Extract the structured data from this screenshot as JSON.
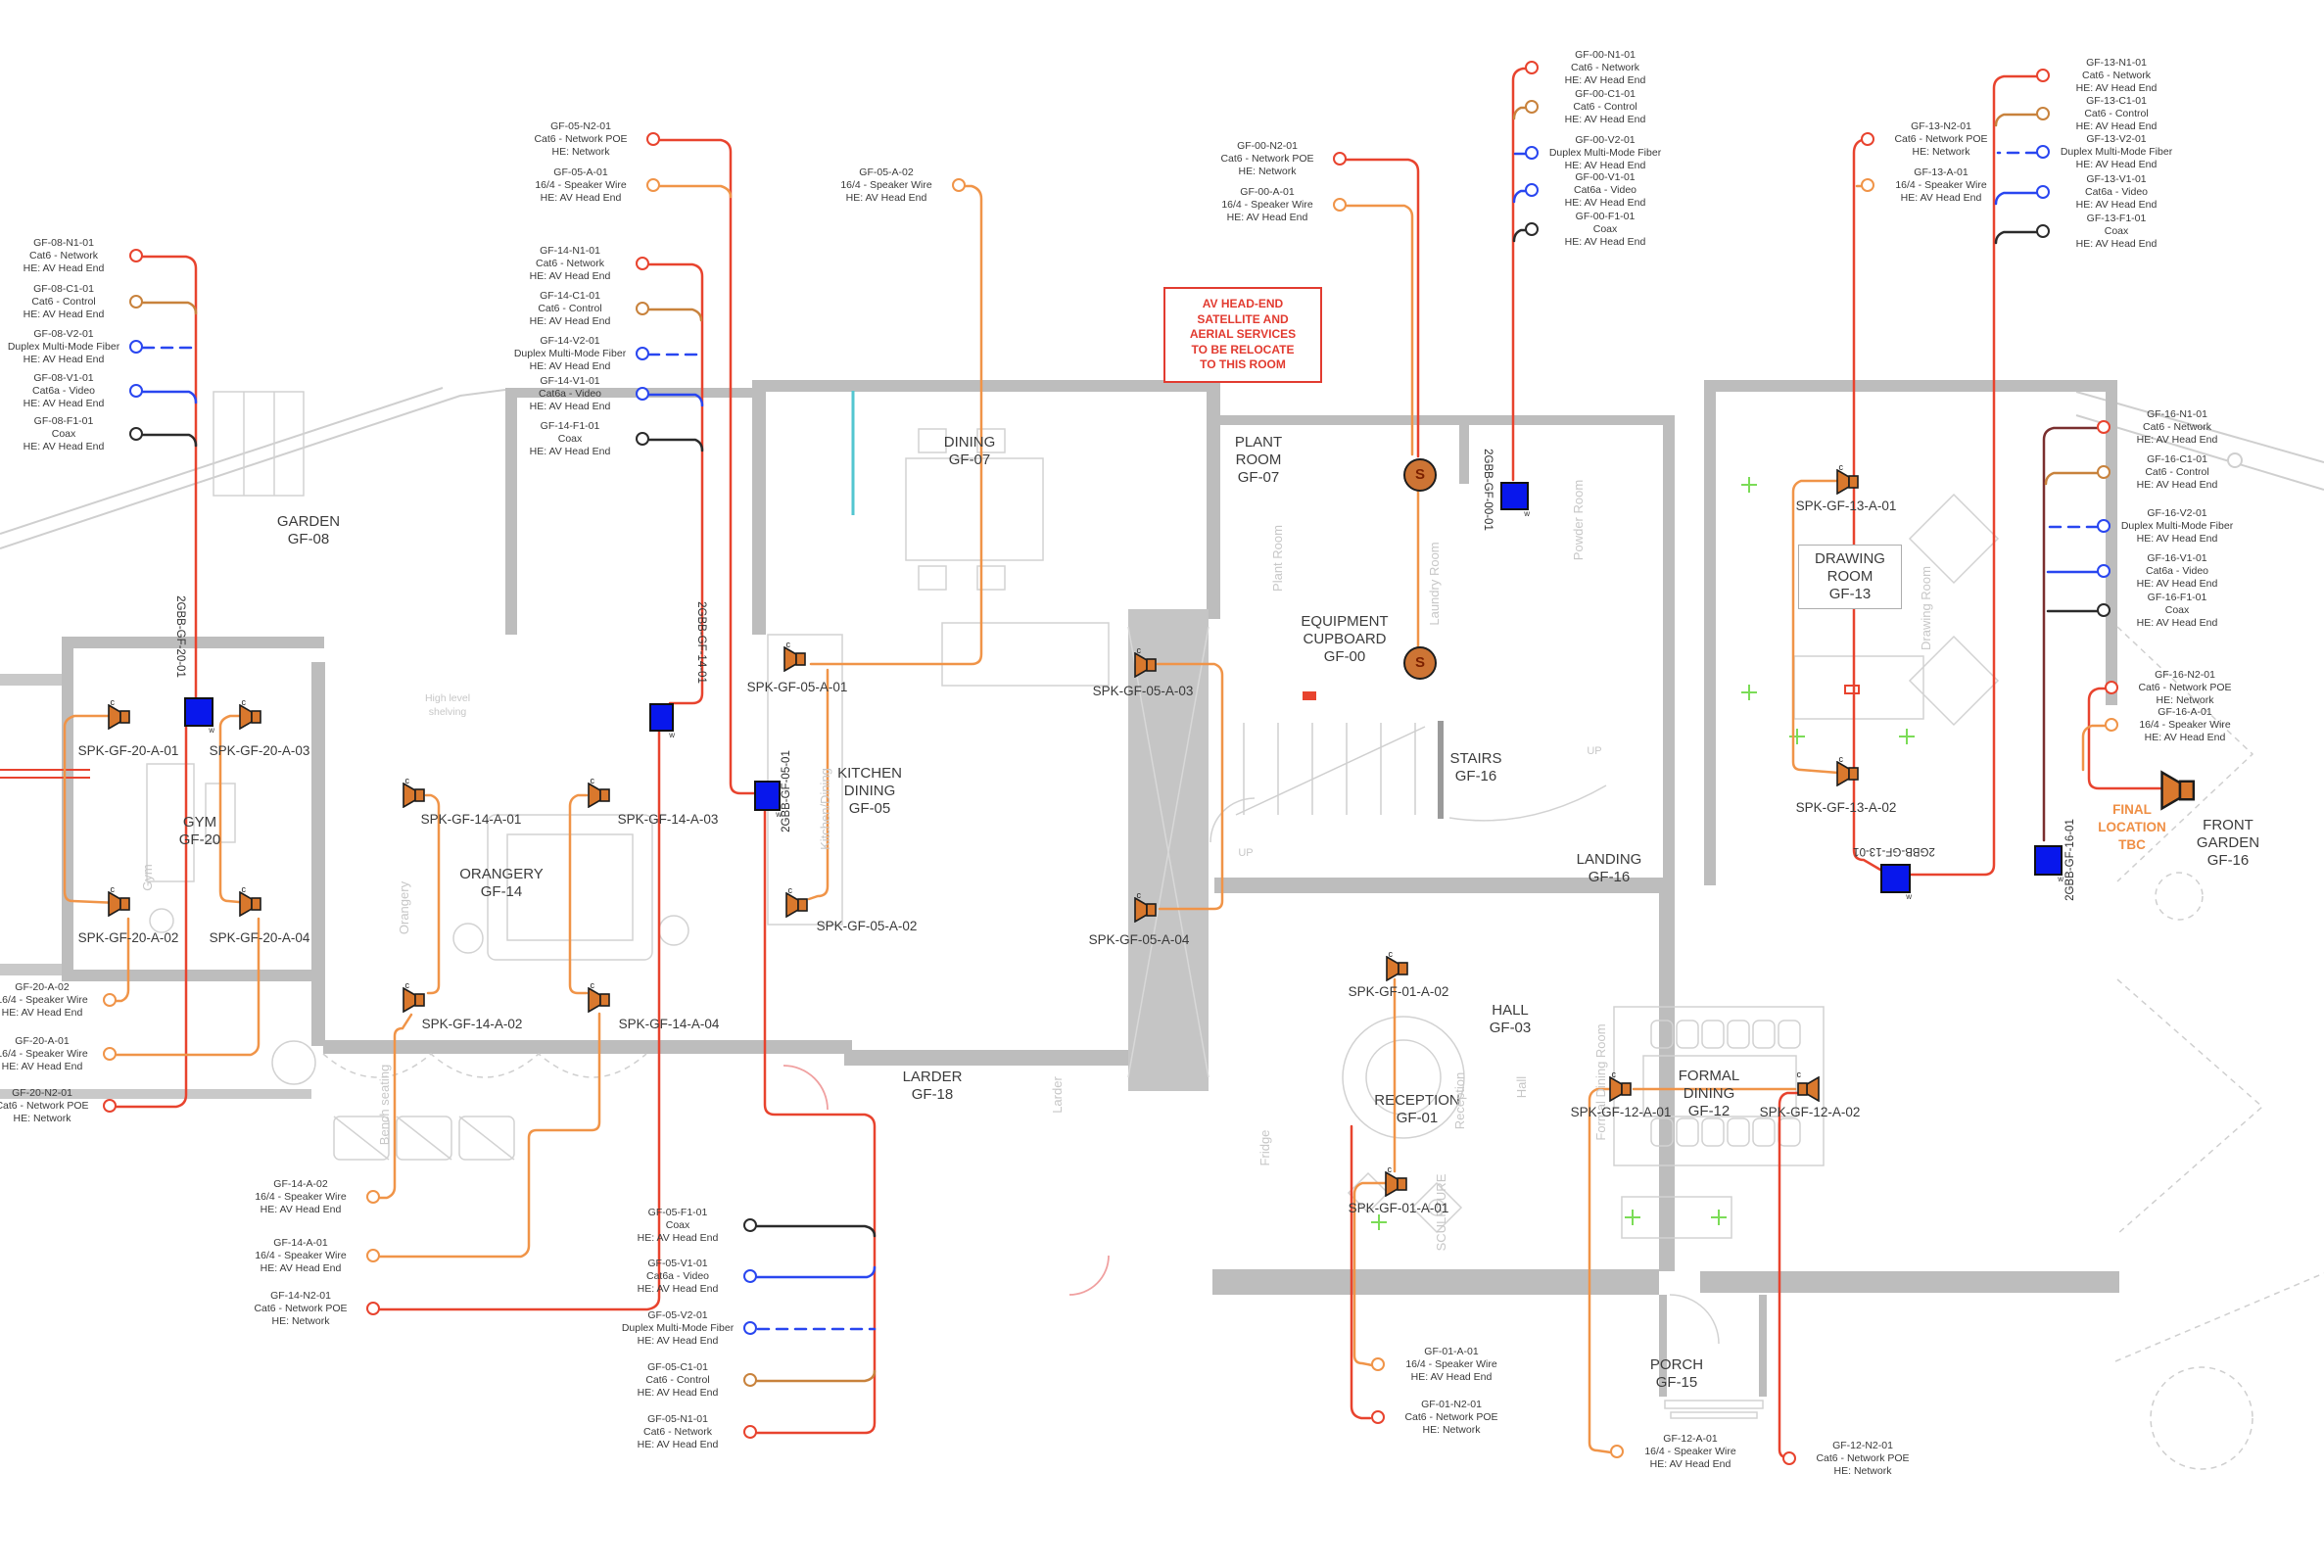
{
  "colors": {
    "network": "#e8432e",
    "control": "#c8823c",
    "fiber": "#2946f0",
    "video": "#2946f0",
    "coax": "#2b2b2b",
    "speaker_wire": "#f09448",
    "device_orange": "#d9782d",
    "backbox_blue": "#0817ec",
    "note_red": "#e23b30",
    "accent_orange": "#ef8f45"
  },
  "note_box": {
    "lines": [
      "AV HEAD-END",
      "SATELLITE AND",
      "AERIAL SERVICES",
      "TO BE RELOCATE",
      "TO THIS ROOM"
    ]
  },
  "final_location_note": {
    "lines": [
      "FINAL",
      "LOCATION",
      "TBC"
    ]
  },
  "s_outlet_label": "S",
  "speaker_marker": "c",
  "backbox_marker": "w",
  "rooms": [
    {
      "lines": [
        "GARDEN",
        "GF-08"
      ]
    },
    {
      "lines": [
        "GYM",
        "GF-20"
      ]
    },
    {
      "lines": [
        "ORANGERY",
        "GF-14"
      ]
    },
    {
      "lines": [
        "DINING",
        "GF-07"
      ]
    },
    {
      "lines": [
        "KITCHEN",
        "DINING",
        "GF-05"
      ]
    },
    {
      "lines": [
        "LARDER",
        "GF-18"
      ]
    },
    {
      "lines": [
        "PLANT",
        "ROOM",
        "GF-07"
      ]
    },
    {
      "lines": [
        "EQUIPMENT",
        "CUPBOARD",
        "GF-00"
      ]
    },
    {
      "lines": [
        "STAIRS",
        "GF-16"
      ]
    },
    {
      "lines": [
        "LANDING",
        "GF-16"
      ]
    },
    {
      "lines": [
        "DRAWING",
        "ROOM",
        "GF-13"
      ]
    },
    {
      "lines": [
        "HALL",
        "GF-03"
      ]
    },
    {
      "lines": [
        "RECEPTION",
        "GF-01"
      ]
    },
    {
      "lines": [
        "FORMAL",
        "DINING",
        "GF-12"
      ]
    },
    {
      "lines": [
        "PORCH",
        "GF-15"
      ]
    },
    {
      "lines": [
        "FRONT",
        "GARDEN",
        "GF-16"
      ]
    }
  ],
  "gray_labels": [
    "Plant Room",
    "Laundry Room",
    "Powder Room",
    "Kitchen/Dining",
    "Drawing Room",
    "Hall",
    "Reception",
    "Orangery",
    "Gym",
    "Larder",
    "Fridge",
    "SCULPTURE",
    "Formal Dining Room",
    "Bench seating",
    "High level shelving",
    "UP",
    "UP"
  ],
  "backboxes": [
    "2GBB-GF-20-01",
    "2GBB-GF-14-01",
    "2GBB-GF-05-01",
    "2GBB-GF-00-01",
    "2GBB-GF-13-01",
    "2GBB-GF-16-01"
  ],
  "speakers": [
    "SPK-GF-20-A-01",
    "SPK-GF-20-A-03",
    "SPK-GF-20-A-02",
    "SPK-GF-20-A-04",
    "SPK-GF-14-A-01",
    "SPK-GF-14-A-03",
    "SPK-GF-14-A-02",
    "SPK-GF-14-A-04",
    "SPK-GF-05-A-01",
    "SPK-GF-05-A-03",
    "SPK-GF-05-A-02",
    "SPK-GF-05-A-04",
    "SPK-GF-13-A-01",
    "SPK-GF-13-A-02",
    "SPK-GF-01-A-02",
    "SPK-GF-01-A-01",
    "SPK-GF-12-A-01",
    "SPK-GF-12-A-02"
  ],
  "callouts": [
    {
      "id": "GF-08-N1-01",
      "cable": "Cat6 - Network",
      "he": "HE: AV Head End"
    },
    {
      "id": "GF-08-C1-01",
      "cable": "Cat6 - Control",
      "he": "HE: AV Head End"
    },
    {
      "id": "GF-08-V2-01",
      "cable": "Duplex Multi-Mode Fiber",
      "he": "HE: AV Head End"
    },
    {
      "id": "GF-08-V1-01",
      "cable": "Cat6a - Video",
      "he": "HE: AV Head End"
    },
    {
      "id": "GF-08-F1-01",
      "cable": "Coax",
      "he": "HE: AV Head End"
    },
    {
      "id": "GF-14-N1-01",
      "cable": "Cat6 - Network",
      "he": "HE: AV Head End"
    },
    {
      "id": "GF-14-C1-01",
      "cable": "Cat6 - Control",
      "he": "HE: AV Head End"
    },
    {
      "id": "GF-14-V2-01",
      "cable": "Duplex Multi-Mode Fiber",
      "he": "HE: AV Head End"
    },
    {
      "id": "GF-14-V1-01",
      "cable": "Cat6a - Video",
      "he": "HE: AV Head End"
    },
    {
      "id": "GF-14-F1-01",
      "cable": "Coax",
      "he": "HE: AV Head End"
    },
    {
      "id": "GF-05-N2-01",
      "cable": "Cat6 - Network POE",
      "he": "HE: Network"
    },
    {
      "id": "GF-05-A-01",
      "cable": "16/4 - Speaker Wire",
      "he": "HE: AV Head End"
    },
    {
      "id": "GF-05-A-02",
      "cable": "16/4 - Speaker Wire",
      "he": "HE: AV Head End"
    },
    {
      "id": "GF-00-N2-01",
      "cable": "Cat6 - Network POE",
      "he": "HE: Network"
    },
    {
      "id": "GF-00-A-01",
      "cable": "16/4 - Speaker Wire",
      "he": "HE: AV Head End"
    },
    {
      "id": "GF-00-N1-01",
      "cable": "Cat6 - Network",
      "he": "HE: AV Head End"
    },
    {
      "id": "GF-00-C1-01",
      "cable": "Cat6 - Control",
      "he": "HE: AV Head End"
    },
    {
      "id": "GF-00-V2-01",
      "cable": "Duplex Multi-Mode Fiber",
      "he": "HE: AV Head End"
    },
    {
      "id": "GF-00-V1-01",
      "cable": "Cat6a - Video",
      "he": "HE: AV Head End"
    },
    {
      "id": "GF-00-F1-01",
      "cable": "Coax",
      "he": "HE: AV Head End"
    },
    {
      "id": "GF-13-N2-01",
      "cable": "Cat6 - Network POE",
      "he": "HE: Network"
    },
    {
      "id": "GF-13-A-01",
      "cable": "16/4 - Speaker Wire",
      "he": "HE: AV Head End"
    },
    {
      "id": "GF-13-N1-01",
      "cable": "Cat6 - Network",
      "he": "HE: AV Head End"
    },
    {
      "id": "GF-13-C1-01",
      "cable": "Cat6 - Control",
      "he": "HE: AV Head End"
    },
    {
      "id": "GF-13-V2-01",
      "cable": "Duplex Multi-Mode Fiber",
      "he": "HE: AV Head End"
    },
    {
      "id": "GF-13-V1-01",
      "cable": "Cat6a - Video",
      "he": "HE: AV Head End"
    },
    {
      "id": "GF-13-F1-01",
      "cable": "Coax",
      "he": "HE: AV Head End"
    },
    {
      "id": "GF-16-N1-01",
      "cable": "Cat6 - Network",
      "he": "HE: AV Head End"
    },
    {
      "id": "GF-16-C1-01",
      "cable": "Cat6 - Control",
      "he": "HE: AV Head End"
    },
    {
      "id": "GF-16-V2-01",
      "cable": "Duplex Multi-Mode Fiber",
      "he": "HE: AV Head End"
    },
    {
      "id": "GF-16-V1-01",
      "cable": "Cat6a - Video",
      "he": "HE: AV Head End"
    },
    {
      "id": "GF-16-F1-01",
      "cable": "Coax",
      "he": "HE: AV Head End"
    },
    {
      "id": "GF-16-N2-01",
      "cable": "Cat6 - Network POE",
      "he": "HE: Network"
    },
    {
      "id": "GF-16-A-01",
      "cable": "16/4 - Speaker Wire",
      "he": "HE: AV Head End"
    },
    {
      "id": "GF-20-A-02",
      "cable": "16/4 - Speaker Wire",
      "he": "HE: AV Head End"
    },
    {
      "id": "GF-20-A-01",
      "cable": "16/4 - Speaker Wire",
      "he": "HE: AV Head End"
    },
    {
      "id": "GF-20-N2-01",
      "cable": "Cat6 - Network POE",
      "he": "HE: Network"
    },
    {
      "id": "GF-14-A-02",
      "cable": "16/4 - Speaker Wire",
      "he": "HE: AV Head End"
    },
    {
      "id": "GF-14-A-01",
      "cable": "16/4 - Speaker Wire",
      "he": "HE: AV Head End"
    },
    {
      "id": "GF-14-N2-01",
      "cable": "Cat6 - Network POE",
      "he": "HE: Network"
    },
    {
      "id": "GF-05-F1-01",
      "cable": "Coax",
      "he": "HE: AV Head End"
    },
    {
      "id": "GF-05-V1-01",
      "cable": "Cat6a - Video",
      "he": "HE: AV Head End"
    },
    {
      "id": "GF-05-V2-01",
      "cable": "Duplex Multi-Mode Fiber",
      "he": "HE: AV Head End"
    },
    {
      "id": "GF-05-C1-01",
      "cable": "Cat6 - Control",
      "he": "HE: AV Head End"
    },
    {
      "id": "GF-05-N1-01",
      "cable": "Cat6 - Network",
      "he": "HE: AV Head End"
    },
    {
      "id": "GF-01-A-01",
      "cable": "16/4 - Speaker Wire",
      "he": "HE: AV Head End"
    },
    {
      "id": "GF-01-N2-01",
      "cable": "Cat6 - Network POE",
      "he": "HE: Network"
    },
    {
      "id": "GF-12-A-01",
      "cable": "16/4 - Speaker Wire",
      "he": "HE: AV Head End"
    },
    {
      "id": "GF-12-N2-01",
      "cable": "Cat6 - Network POE",
      "he": "HE: Network"
    }
  ]
}
